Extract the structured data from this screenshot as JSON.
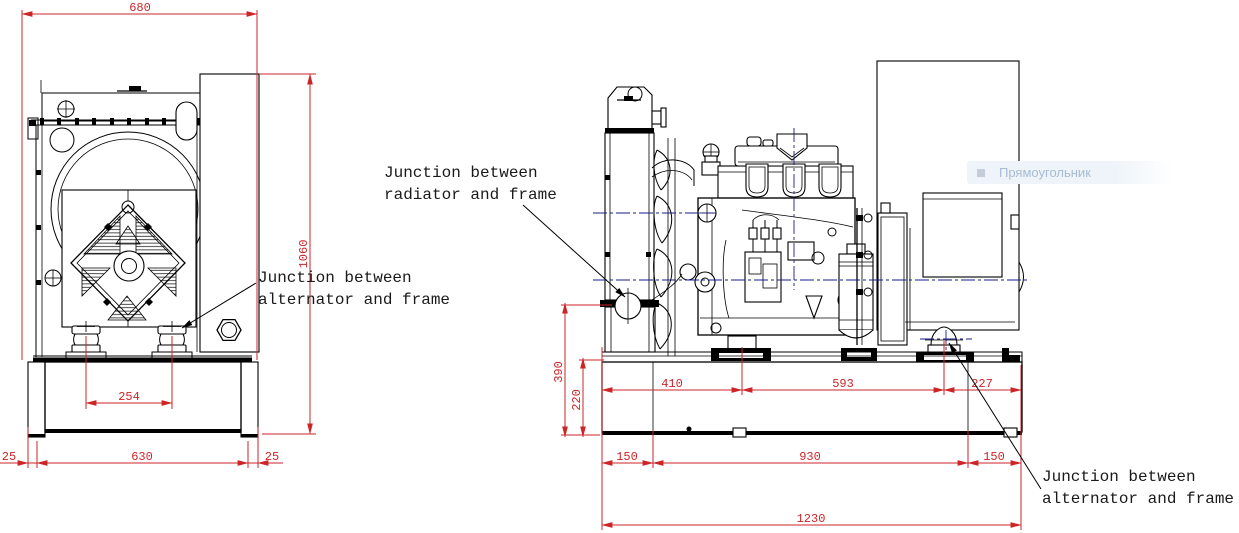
{
  "front_view": {
    "dims": {
      "overall_width": "680",
      "overall_height": "1060",
      "mount_spacing": "254",
      "frame_width": "630",
      "foot_offset_left": "25",
      "foot_offset_right": "25"
    },
    "annotation_alternator": [
      "Junction between",
      "alternator and frame"
    ]
  },
  "side_view": {
    "dims": {
      "radiator_junction_height": "390",
      "frame_height": "220",
      "frame_to_engine_mount": "410",
      "engine_to_alternator_mount": "593",
      "alternator_mount_to_end": "227",
      "foot_offset_left": "150",
      "foot_span": "930",
      "foot_offset_right": "150",
      "overall_length": "1230"
    },
    "annotation_radiator": [
      "Junction between",
      "radiator and frame"
    ],
    "annotation_alternator": [
      "Junction between",
      "alternator and frame"
    ]
  },
  "overlay": {
    "tooltip_label": "Прямоугольник"
  },
  "colors": {
    "dimension_red": "#cd2428",
    "line_black": "#000000",
    "centerline_blue": "#1a1a8c",
    "tooltip_bg": "#eef4f9",
    "tooltip_text": "#a9bbd2",
    "tooltip_bullet": "#c4cdd9"
  }
}
